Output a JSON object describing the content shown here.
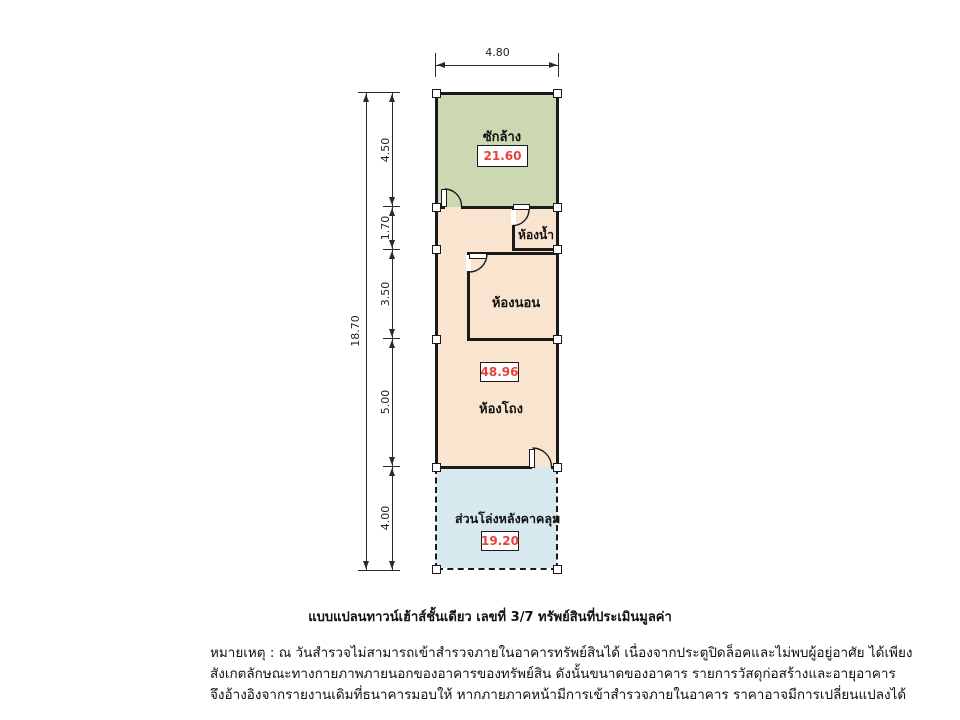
{
  "plan": {
    "caption": "แบบแปลนทาวน์เฮ้าส์ชั้นเดียว เลขที่ 3/7  ทรัพย์สินที่ประเมินมูลค่า",
    "rooms": {
      "laundry": {
        "label": "ซักล้าง",
        "area": "21.60"
      },
      "bathroom": {
        "label": "ห้องน้ำ"
      },
      "bedroom": {
        "label": "ห้องนอน"
      },
      "hall": {
        "label": "ห้องโถง",
        "area": "48.96"
      },
      "covered_open_area": {
        "label": "ส่วนโล่งหลังคาคลุม",
        "area": "19.20"
      }
    },
    "dimensions": {
      "top_width": "4.80",
      "total_height": "18.70",
      "segments": [
        "4.50",
        "1.70",
        "3.50",
        "5.00",
        "4.00"
      ]
    },
    "colors": {
      "laundry_fill": "#ccd8b2",
      "interior_fill": "#f9e4d0",
      "open_area_fill": "#d7e8ef",
      "wall": "#1a1a1a",
      "area_value_text": "#e8403c"
    }
  },
  "notes": {
    "line1": "หมายเหตุ : ณ วันสำรวจไม่สามารถเข้าสำรวจภายในอาคารทรัพย์สินได้ เนื่องจากประตูปิดล็อคและไม่พบผู้อยู่อาศัย ได้เพียง",
    "line2": "สังเกตลักษณะทางกายภาพภายนอกของอาคารของทรัพย์สิน ดังนั้นขนาดของอาคาร รายการวัสดุก่อสร้างและอายุอาคาร",
    "line3": "จึงอ้างอิงจากรายงานเดิมที่ธนาคารมอบให้ หากภายภาคหน้ามีการเข้าสำรวจภายในอาคาร ราคาอาจมีการเปลี่ยนแปลงได้"
  }
}
